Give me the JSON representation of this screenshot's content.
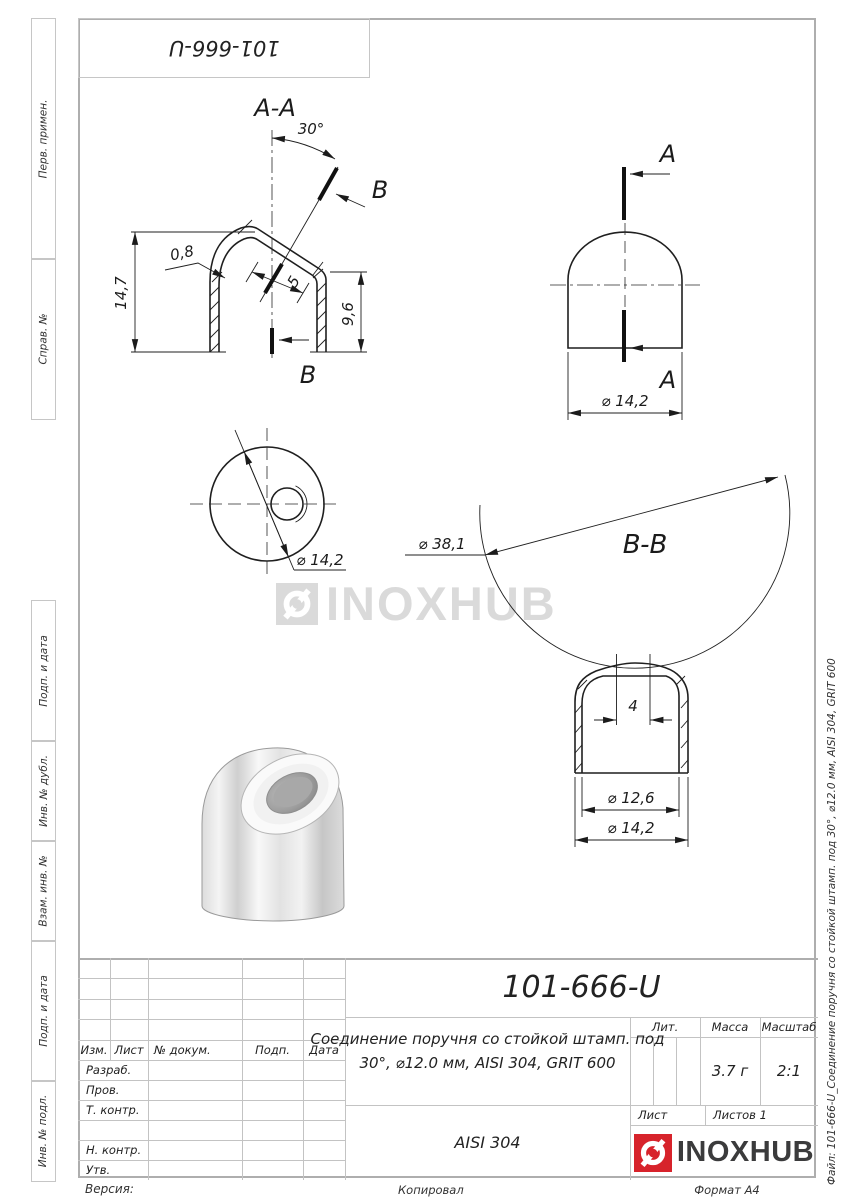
{
  "corner": {
    "part_flipped": "101-666-U"
  },
  "margins": {
    "left_labels": [
      "Перв. примен.",
      "Справ. №",
      "Подп. и дата",
      "Инв. № дубл.",
      "Взам. инв. №",
      "Подп. и дата",
      "Инв. № подл."
    ],
    "file_label": "Файл: 101-666-U_Соединение поручня со стойкой штамп. под 30°, ⌀12.0 мм, AISI 304, GRIT 600"
  },
  "watermark": {
    "text": "INOXHUB"
  },
  "views": {
    "section_aa": {
      "title": "A-A",
      "angle": "30°",
      "thickness": "0,8",
      "len5": "5",
      "h_left": "14,7",
      "h_right": "9,6",
      "cut_top": "B",
      "cut_bottom": "B"
    },
    "view_a": {
      "label_top": "A",
      "label_bottom": "A",
      "dia": "⌀ 14,2"
    },
    "bottom_view": {
      "dia": "⌀ 14,2"
    },
    "section_bb": {
      "title": "B-B",
      "dia_tube": "⌀ 38,1",
      "w_top": "4",
      "dia_inner": "⌀ 12,6",
      "dia_outer": "⌀ 14,2"
    }
  },
  "stamp": {
    "part_number": "101-666-U",
    "title_line1": "Соединение поручня со стойкой штамп. под",
    "title_line2": "30°, ⌀12.0 мм, AISI 304, GRIT 600",
    "material": "AISI 304",
    "headers": {
      "izm": "Изм.",
      "list": "Лист",
      "doc": "№ докум.",
      "podp": "Подп.",
      "data": "Дата"
    },
    "sig_rows": [
      "Разраб.",
      "Пров.",
      "Т. контр.",
      "",
      "Н. контр.",
      "Утв."
    ],
    "lit": "Лит.",
    "mass": "Масса",
    "scale": "Масштаб",
    "mass_value": "3.7 г",
    "scale_value": "2:1",
    "sheet": "Лист",
    "sheets": "Листов 1",
    "brand": "INOXHUB",
    "brand_red": "#d7232b"
  },
  "footer": {
    "version": "Версия:",
    "copied": "Копировал",
    "format": "Формат А4"
  }
}
